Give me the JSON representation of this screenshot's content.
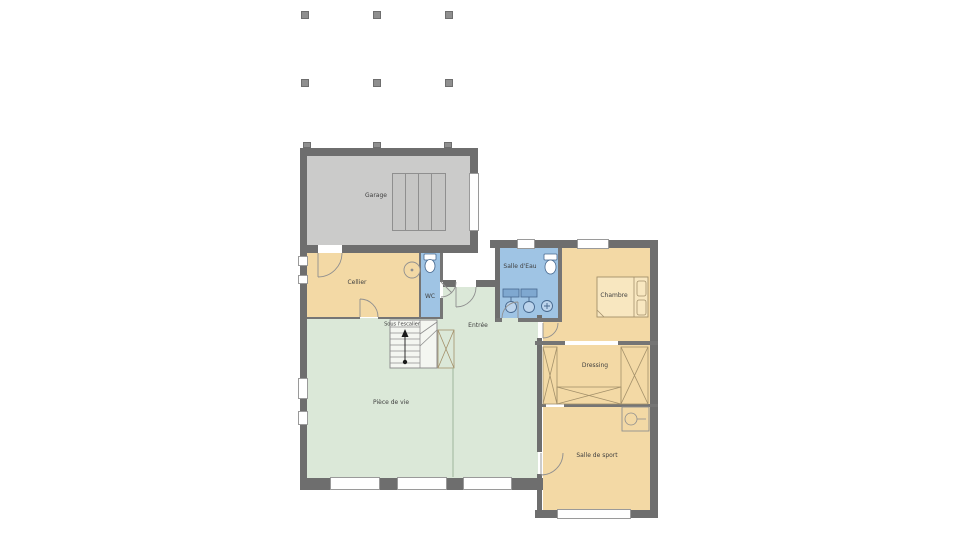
{
  "plan": {
    "type": "floor-plan",
    "rooms": [
      {
        "id": "garage",
        "label": "Garage"
      },
      {
        "id": "cellier",
        "label": "Cellier"
      },
      {
        "id": "wc",
        "label": "WC"
      },
      {
        "id": "salle_eau",
        "label": "Salle d'Eau"
      },
      {
        "id": "chambre",
        "label": "Chambre"
      },
      {
        "id": "entree",
        "label": "Entrée"
      },
      {
        "id": "sous_escalier",
        "label": "Sous l'escalier"
      },
      {
        "id": "dressing",
        "label": "Dressing"
      },
      {
        "id": "piece_de_vie",
        "label": "Pièce de vie"
      },
      {
        "id": "salle_de_sport",
        "label": "Salle de sport"
      }
    ],
    "colors": {
      "wall": "#6e6e6e",
      "partition": "#757575",
      "garage": "#cbcbca",
      "garage2": "#c6c6c5",
      "tan": "#f3d9a5",
      "tanlight": "#f8e7c0",
      "blue": "#9fc4e4",
      "bluelight": "#bcd4ec",
      "green": "#dbe8d8",
      "stairfill": "#f4f6f1",
      "line": "#8f8f8f",
      "furntan": "#a3906a",
      "furnblue": "#47688e",
      "label": "#3f3f3f",
      "winb": "#9a9a9a",
      "post": "#8f8f8f"
    }
  }
}
